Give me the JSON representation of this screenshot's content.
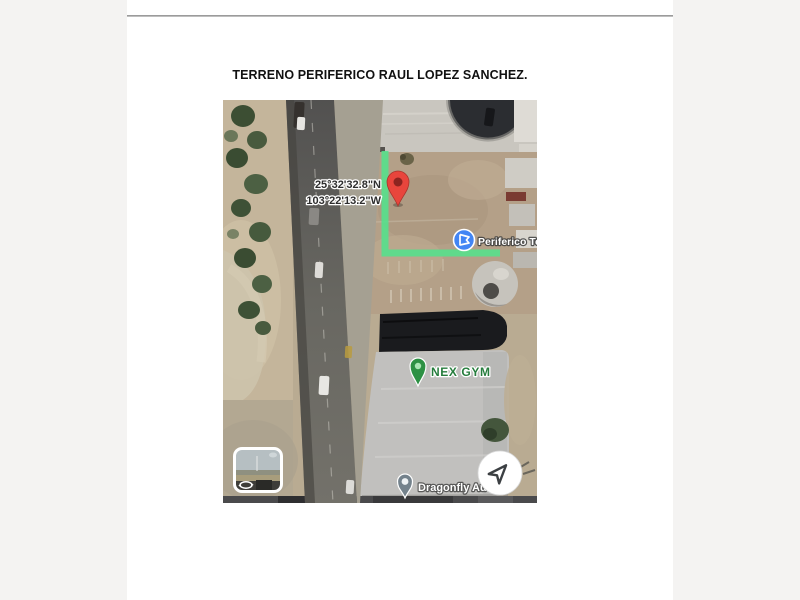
{
  "document": {
    "title": "TERRENO PERIFERICO RAUL LOPEZ SANCHEZ."
  },
  "map": {
    "coordinates": {
      "line1": "25°32'32.8\"N",
      "line2": "103°22'13.2\"W"
    },
    "labels": {
      "periferico": "Periferico Terr",
      "nex_gym": "NEX GYM",
      "dragonfly": "Dragonfly Au"
    },
    "colors": {
      "route_green": "#57e08c",
      "pin_red": "#e8453c",
      "pin_red_inner": "#8c2420",
      "gym_green": "#2d9144",
      "gym_text_green": "#267d3d",
      "place_blue": "#4285f4",
      "dragonfly_gray": "#74828c"
    }
  }
}
